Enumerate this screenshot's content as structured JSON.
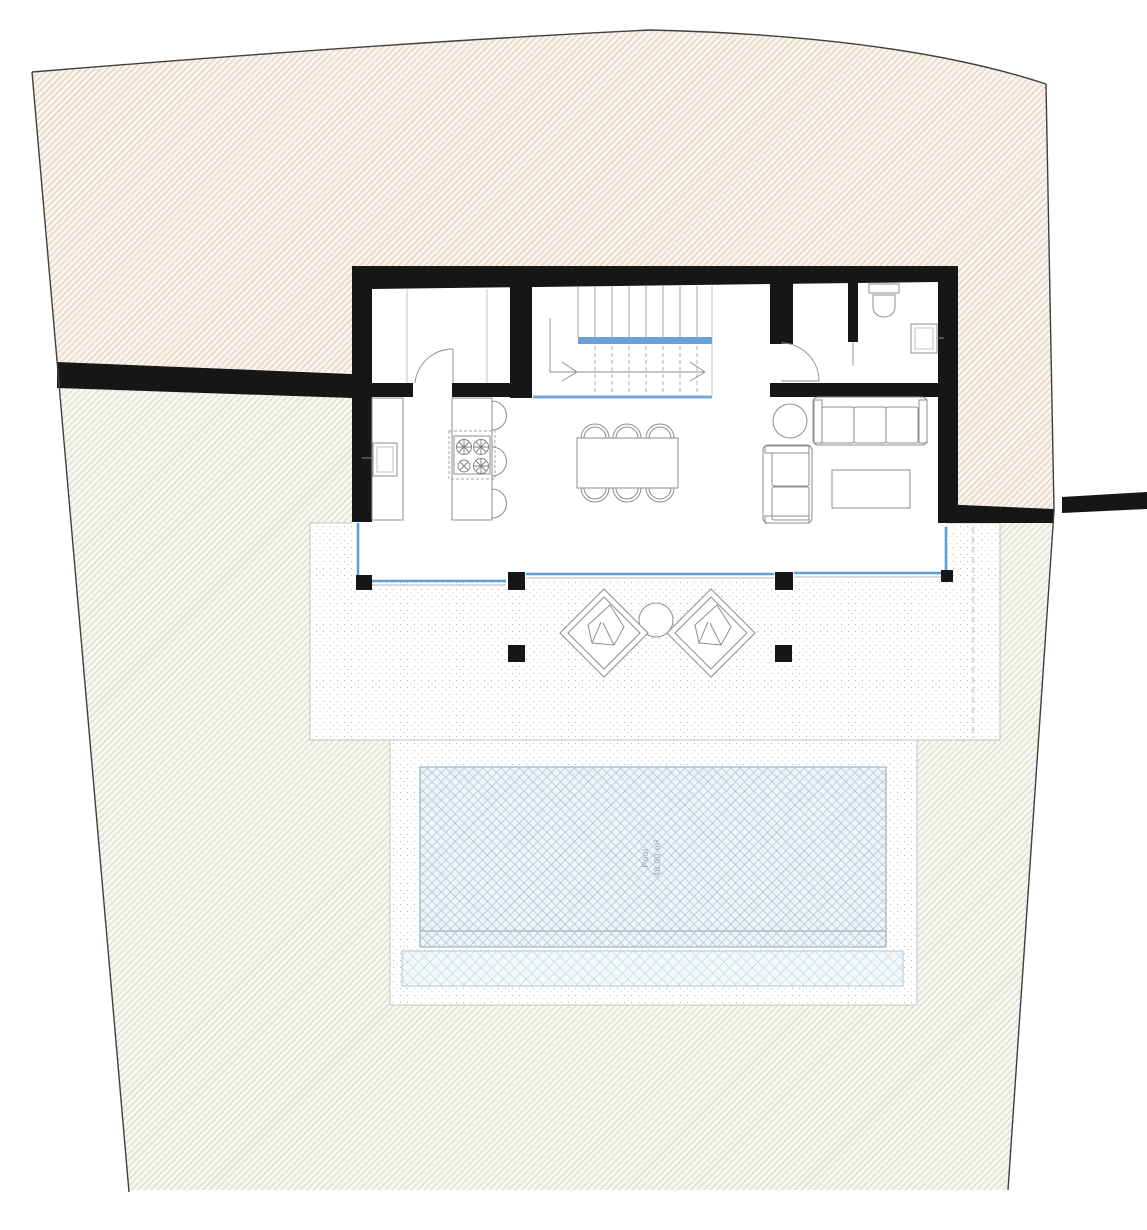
{
  "pool": {
    "label_line1": "Pool",
    "label_line2": "40.00 m²"
  },
  "colors": {
    "wall_black": "#161616",
    "glass_blue": "#5f9fd8",
    "stair_landing_blue": "#6aa2d8",
    "beige_hatch_line": "#dcc3b1",
    "beige_background": "#faf3eb",
    "green_hatch_line": "#cdd2bf",
    "green_background": "#f6f8f0",
    "pool_hatch_line": "#9cb6ca",
    "pool_background": "#edf3f7",
    "pool_overflow_line": "#b7cbda",
    "pool_overflow_background": "#f3f8fb",
    "site_boundary": "#3f3f3f",
    "tile_line": "#d8d8d4",
    "stipple_dot": "#b7bab6"
  }
}
